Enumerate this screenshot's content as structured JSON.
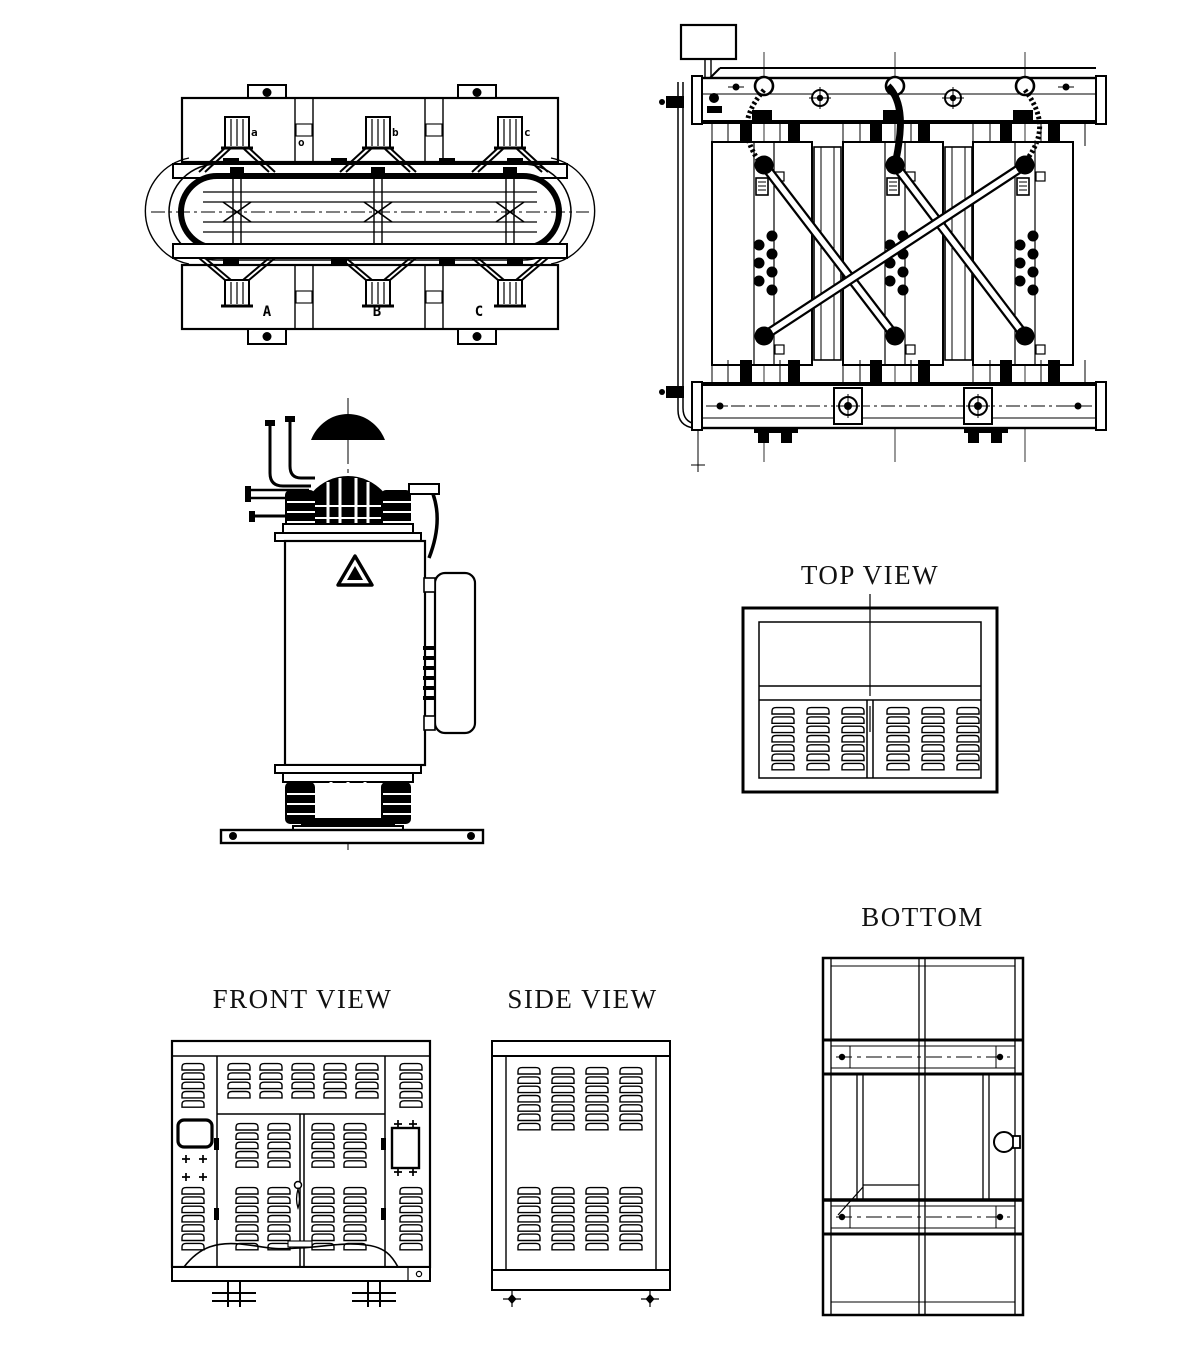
{
  "sheet": {
    "description": "Dry-type transformer outline engineering drawing, six orthographic views",
    "background_color": "#ffffff",
    "line_color": "#000000"
  },
  "views": {
    "top_view": {
      "title": "TOP VIEW"
    },
    "front_view": {
      "title": "FRONT VIEW"
    },
    "side_view": {
      "title": "SIDE VIEW"
    },
    "bottom_view": {
      "title": "BOTTOM"
    }
  },
  "core_assembly": {
    "lv_terminal_labels": [
      "a",
      "b",
      "c"
    ],
    "neutral_label": "o",
    "phase_labels": [
      "A",
      "B",
      "C"
    ]
  }
}
